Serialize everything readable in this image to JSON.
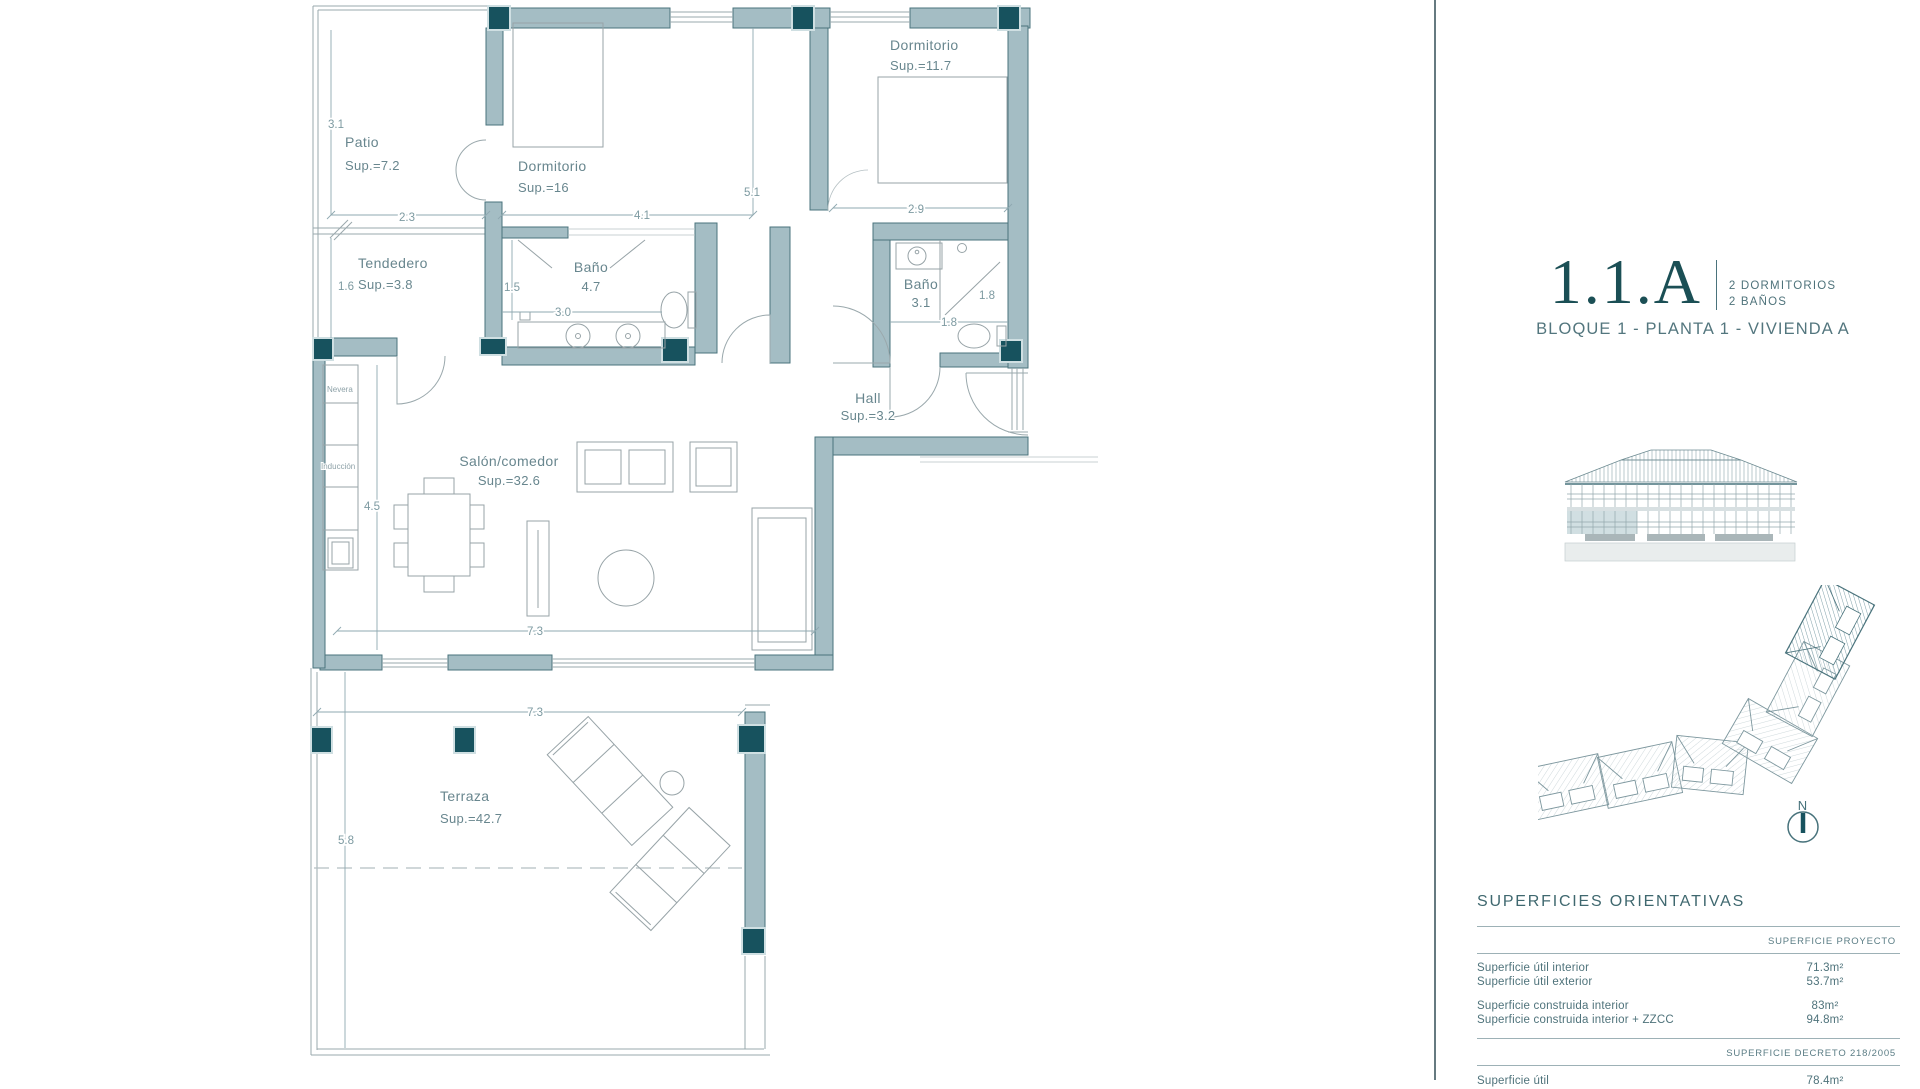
{
  "colors": {
    "wall": "#a4bdc4",
    "wall_stroke": "#4a737c",
    "pillar": "#17525e",
    "dim_text": "#7d9aa1",
    "label_text": "#68868e",
    "accent_dark": "#1b4f55",
    "highlight": "#b9ced3"
  },
  "plan": {
    "rooms": {
      "patio": {
        "name": "Patio",
        "sup": "Sup.=7.2"
      },
      "dormitorio1": {
        "name": "Dormitorio",
        "sup": "Sup.=16"
      },
      "dormitorio2": {
        "name": "Dormitorio",
        "sup": "Sup.=11.7"
      },
      "tendedero": {
        "name": "Tendedero",
        "sup": "Sup.=3.8"
      },
      "bano1": {
        "name": "Baño",
        "sup": "4.7"
      },
      "bano2": {
        "name": "Baño",
        "sup": "3.1"
      },
      "hall": {
        "name": "Hall",
        "sup": "Sup.=3.2"
      },
      "salon": {
        "name": "Salón/comedor",
        "sup": "Sup.=32.6"
      },
      "terraza": {
        "name": "Terraza",
        "sup": "Sup.=42.7"
      }
    },
    "dims": {
      "patio_h": "3.1",
      "patio_w": "2.3",
      "tend_h": "1.6",
      "dorm1_w": "4.1",
      "dorm1_h": "5.1",
      "dorm2_w": "2.9",
      "bano1_gap": "1.5",
      "bano1_w": "3.0",
      "bano2_shower": "1.8",
      "bano2_w": "1.8",
      "salon_h": "4.5",
      "salon_w": "7.3",
      "terraza_w": "7.3",
      "terraza_h": "5.8"
    },
    "kitchen": {
      "fridge": "Nevera",
      "hob": "Inducción"
    }
  },
  "panel": {
    "unit_code": "1.1.A",
    "features": [
      "2 DORMITORIOS",
      "2 BAÑOS"
    ],
    "location": "BLOQUE 1 - PLANTA 1 - VIVIENDA A",
    "north": "N",
    "table": {
      "title": "SUPERFICIES ORIENTATIVAS",
      "project_header": "SUPERFICIE PROYECTO",
      "rows_a": [
        {
          "label": "Superficie útil interior",
          "value": "71.3m²"
        },
        {
          "label": "Superficie útil exterior",
          "value": "53.7m²"
        }
      ],
      "rows_b": [
        {
          "label": "Superficie construida interior",
          "value": "83m²"
        },
        {
          "label": "Superficie construida interior + ZZCC",
          "value": "94.8m²"
        }
      ],
      "decree_header": "SUPERFICIE DECRETO 218/2005",
      "rows_c": [
        {
          "label": "Superficie útil",
          "value": "78.4m²"
        }
      ]
    }
  }
}
